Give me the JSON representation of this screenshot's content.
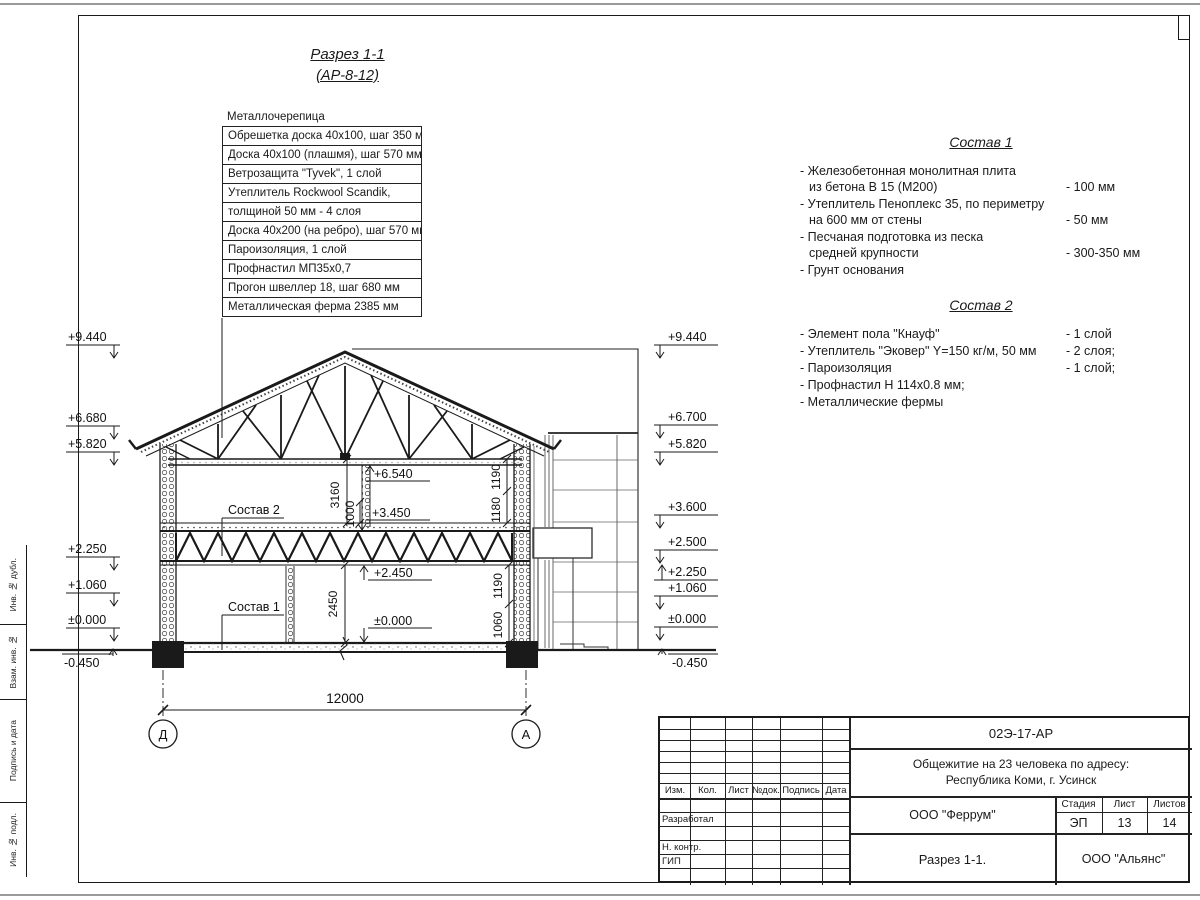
{
  "page": {
    "ink": "#1a1a1a",
    "thin_line": "#555",
    "edge_line": "#9a9a9a"
  },
  "drawing_title": {
    "line1": "Разрез 1-1",
    "line2": "(АР-8-12)"
  },
  "callout": {
    "header": "Металлочерепица",
    "rows": [
      "Обрешетка доска 40х100, шаг 350 мм",
      "Доска 40х100 (плашмя), шаг 570 мм",
      "Ветрозащита \"Tyvek\", 1 слой",
      "Утеплитель Rockwool Scandik,",
      "толщиной 50 мм - 4 слоя",
      "Доска 40х200 (на ребро), шаг 570 мм",
      "Пароизоляция, 1 слой",
      "Профнастил МП35х0,7",
      "Прогон швеллер 18, шаг 680 мм",
      "Металлическая ферма 2385 мм"
    ]
  },
  "sostav1": {
    "title": "Состав 1",
    "items": [
      {
        "text": "- Железобетонная  монолитная плита\nиз бетона В 15 (М200)",
        "value": "- 100 мм"
      },
      {
        "text": "- Утеплитель Пеноплекс 35, по периметру\nна 600 мм от стены",
        "value": "- 50 мм"
      },
      {
        "text": "- Песчаная подготовка из песка\nсредней крупности",
        "value": "- 300-350 мм"
      },
      {
        "text": "- Грунт основания",
        "value": ""
      }
    ]
  },
  "sostav2": {
    "title": "Состав 2",
    "items": [
      {
        "text": "- Элемент пола \"Кнауф\"",
        "value": "- 1 слой"
      },
      {
        "text": "- Утеплитель \"Эковер\" Y=150 кг/м, 50 мм",
        "value": "- 2 слоя;"
      },
      {
        "text": "- Пароизоляция",
        "value": "- 1 слой;"
      },
      {
        "text": "- Профнастил Н 114х0.8 мм;",
        "value": ""
      },
      {
        "text": "- Металлические фермы",
        "value": ""
      }
    ]
  },
  "elevations": {
    "left": [
      "+9.440",
      "+6.680",
      "+5.820",
      "+2.250",
      "+1.060",
      "±0.000",
      "-0.450"
    ],
    "right": [
      "+9.440",
      "+6.700",
      "+5.820",
      "+3.600",
      "+2.500",
      "+2.250",
      "+1.060",
      "±0.000",
      "-0.450"
    ]
  },
  "interior": {
    "ceiling": "+6.540",
    "floor2": "+3.450",
    "chord": "+2.450",
    "floor1": "±0.000",
    "h3160": "3160",
    "h1000": "1000",
    "h2450": "2450",
    "r1190t": "1190",
    "r1180": "1180",
    "r1190b": "1190",
    "r1060": "1060",
    "ref2": "Состав 2",
    "ref1": "Состав 1"
  },
  "axes": {
    "left": "Д",
    "right": "А",
    "span": "12000"
  },
  "titleblock": {
    "code": "02Э-17-АР",
    "project": "Общежитие на 23 человека по адресу:\nРеспублика Коми, г. Усинск",
    "cols": [
      "Изм.",
      "Кол.",
      "Лист",
      "№док.",
      "Подпись",
      "Дата"
    ],
    "row_labels": [
      "Разработал",
      "Н. контр.",
      "ГИП"
    ],
    "org": "ООО \"Феррум\"",
    "stage_label": "Стадия",
    "sheet_label": "Лист",
    "sheets_label": "Листов",
    "stage": "ЭП",
    "sheet": "13",
    "sheets": "14",
    "title": "Разрез 1-1.",
    "org2": "ООО \"Альянс\""
  },
  "side_column": {
    "labels": [
      "Инв. № дубл.",
      "Взам. инв. №",
      "Подпись и дата",
      "Инв. № подл."
    ]
  }
}
